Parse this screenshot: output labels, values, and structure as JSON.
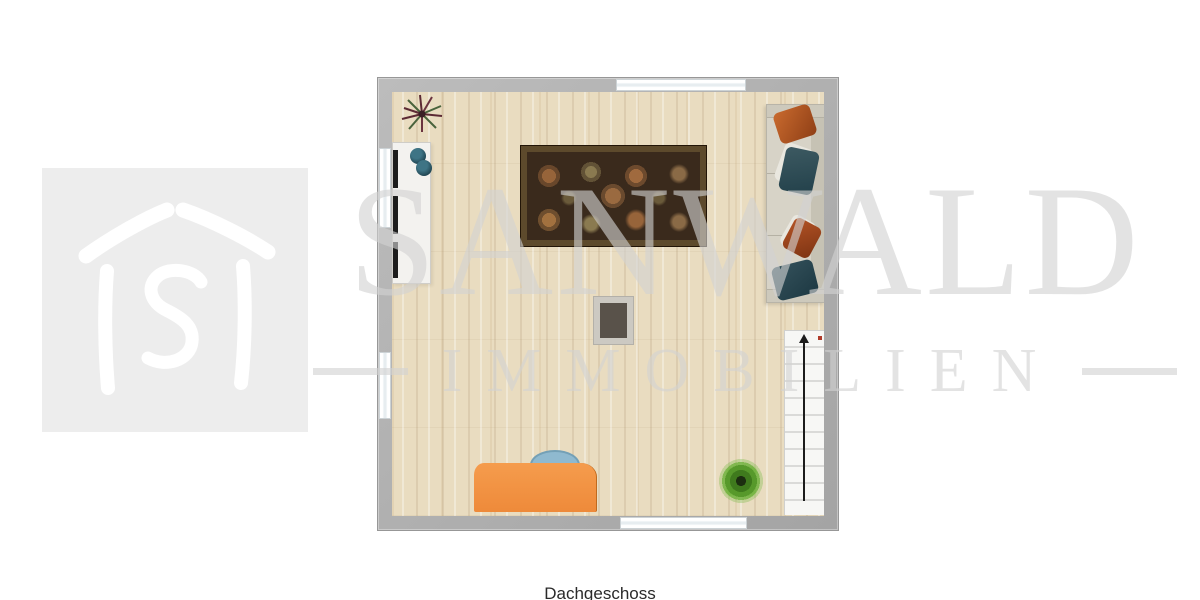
{
  "floor_label": "Dachgeschoss",
  "watermark": {
    "line1": "SANWALD",
    "line2": "IMMOBILIEN",
    "color": "#d9d9d9"
  },
  "logo": {
    "name": "sanwald-house-logo",
    "box_color": "#ededed",
    "glyph_color": "#ffffff",
    "glyph": "house outline with letter S"
  },
  "floorplan": {
    "room_label": "attic open living area",
    "wall_color": "#adadad",
    "floor_color": "#e9dcc0",
    "window_count": 4,
    "stairs_direction": "up",
    "furniture": [
      {
        "name": "kitchen-sideboard",
        "color": "#f3f2ef"
      },
      {
        "name": "wall-tv",
        "color": "#1d1d1d"
      },
      {
        "name": "decor-bowls",
        "color": "#2e5a66"
      },
      {
        "name": "area-rug",
        "color": "#3a2a1c",
        "border_color": "#5d4a2c"
      },
      {
        "name": "sofa",
        "color": "#d7d3c7",
        "pillow_colors": [
          "#b35a28",
          "#2e4f58"
        ]
      },
      {
        "name": "chimney-block",
        "color": "#59524a"
      },
      {
        "name": "desk",
        "color": "#f09043"
      },
      {
        "name": "desk-chair",
        "color": "#8fb9cf"
      },
      {
        "name": "stairs",
        "color": "#f7f7f5"
      },
      {
        "name": "plant-spiky",
        "color": "#5c2a34"
      },
      {
        "name": "plant-fern",
        "color": "#57992b"
      }
    ]
  }
}
